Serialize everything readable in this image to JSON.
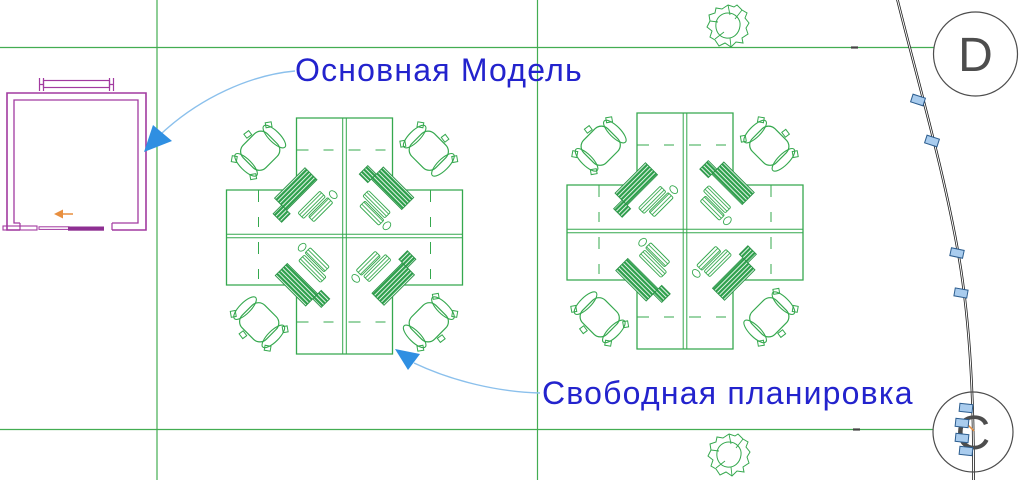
{
  "drawing": {
    "annotations": {
      "main_model": {
        "label": "Основная Модель"
      },
      "free_plan": {
        "label": "Свободная планировка"
      }
    },
    "grid_bubbles": {
      "d": {
        "label": "D"
      },
      "c": {
        "label": "C"
      }
    },
    "clusters": [
      {
        "name": "workstation-cluster-left",
        "desks": 4,
        "chairs": 4,
        "monitors": 4
      },
      {
        "name": "workstation-cluster-right",
        "desks": 4,
        "chairs": 4,
        "monitors": 4
      }
    ],
    "trees": 2,
    "curve_markers": 8,
    "colors": {
      "furniture_green": "#35a84e",
      "grid_green": "#43ad52",
      "room_magenta": "#a23aa0",
      "door_magenta": "#8e2f92",
      "annotation_text": "#2323cd",
      "leader_line": "#8bc0ec",
      "leader_arrow": "#2f8fe2",
      "marker_fill": "#a9ccee",
      "marker_stroke": "#2c5d8f",
      "bubble_gray": "#4d4d4d",
      "orange": "#e88f3f",
      "curve_black": "#1e1e1e"
    }
  }
}
